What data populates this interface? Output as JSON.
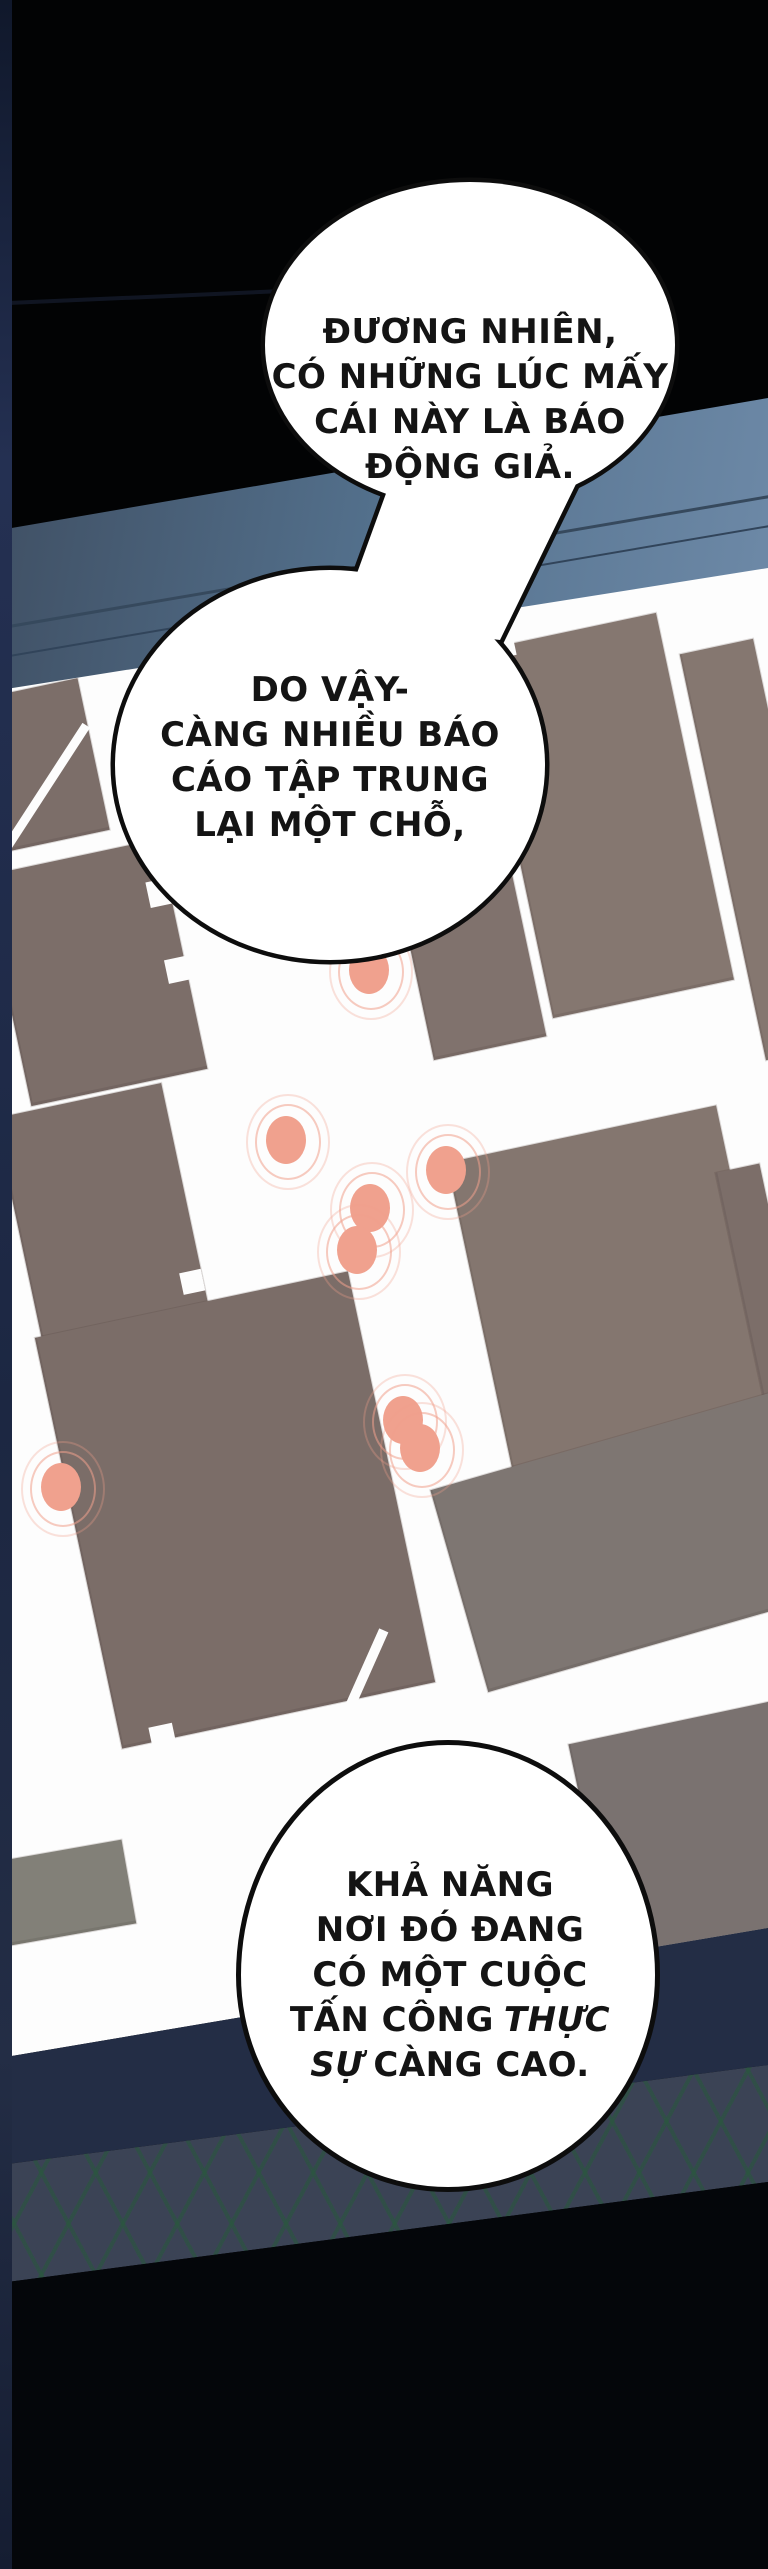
{
  "bubbles": [
    {
      "lines": [
        "ĐƯƠNG NHIÊN,",
        "CÓ NHỮNG LÚC MẤY",
        "CÁI NÀY LÀ BÁO",
        "ĐỘNG GIẢ."
      ]
    },
    {
      "lines": [
        "DO VẬY-",
        "CÀNG NHIỀU BÁO",
        "CÁO TẬP TRUNG",
        "LẠI MỘT CHỖ,"
      ]
    },
    {
      "lines_pre": [
        "KHẢ NĂNG",
        "NƠI ĐÓ ĐANG",
        "CÓ MỘT CUỘC"
      ],
      "line4": {
        "normal": "TẤN CÔNG",
        "italic": "THỰC"
      },
      "line5": {
        "italic": "SỰ",
        "normal": "CÀNG CAO."
      }
    }
  ],
  "map": {
    "alert_color": "#f0a18e",
    "alert_dots": [
      {
        "x": 369,
        "y": 970
      },
      {
        "x": 286,
        "y": 1140
      },
      {
        "x": 446,
        "y": 1170
      },
      {
        "x": 370,
        "y": 1208
      },
      {
        "x": 357,
        "y": 1250
      },
      {
        "x": 403,
        "y": 1420
      },
      {
        "x": 420,
        "y": 1448
      },
      {
        "x": 61,
        "y": 1487
      }
    ],
    "buildings": [
      {
        "x": -35,
        "y": 690,
        "w": 130,
        "h": 155,
        "rot": -12,
        "color": "#7c6e69"
      },
      {
        "x": 5,
        "y": 855,
        "w": 180,
        "h": 235,
        "rot": -12,
        "color": "#7c6e69",
        "notches": [
          {
            "dx": 158,
            "dy": 40,
            "s": 26
          },
          {
            "dx": 160,
            "dy": 120,
            "s": 24
          }
        ]
      },
      {
        "x": 512,
        "y": 628,
        "w": 185,
        "h": 375,
        "rot": -12,
        "color": "#857770",
        "notches": [
          {
            "dx": 20,
            "dy": -8,
            "s": 20
          }
        ]
      },
      {
        "x": 722,
        "y": 642,
        "w": 75,
        "h": 415,
        "rot": -12,
        "color": "#857770"
      },
      {
        "x": 415,
        "y": 880,
        "w": 115,
        "h": 170,
        "rot": -12,
        "color": "#80726d"
      },
      {
        "x": 18,
        "y": 1098,
        "w": 170,
        "h": 240,
        "rot": -12,
        "color": "#7c6e69",
        "notches": [
          {
            "dx": 148,
            "dy": 190,
            "s": 22
          }
        ]
      },
      {
        "x": 482,
        "y": 1130,
        "w": 275,
        "h": 365,
        "rot": -12,
        "color": "#84766f",
        "notches": [
          {
            "dx": 250,
            "dy": 300,
            "s": 24
          },
          {
            "dx": 60,
            "dy": 350,
            "s": 22
          }
        ]
      },
      {
        "x": 745,
        "y": 1165,
        "w": 45,
        "h": 290,
        "rot": -12,
        "color": "#7c6e69"
      },
      {
        "x": 75,
        "y": 1300,
        "w": 320,
        "h": 420,
        "rot": -12,
        "color": "#7b6d68",
        "notches": [
          {
            "dx": 30,
            "dy": 405,
            "s": 24
          }
        ]
      },
      {
        "x": 450,
        "y": 1420,
        "w": 480,
        "h": 210,
        "rot": -16,
        "color": "#7e7672"
      },
      {
        "x": 590,
        "y": 1720,
        "w": 210,
        "h": 230,
        "rot": -12,
        "color": "#7a7270"
      },
      {
        "x": -20,
        "y": 1852,
        "w": 150,
        "h": 85,
        "rot": -10,
        "color": "#828078"
      }
    ]
  },
  "colors": {
    "map_bg": "#fdfdfd",
    "band_blue_left": "#3f4f63",
    "band_blue_right": "#6e8aa8",
    "navy_band": "#232d45",
    "hatch_bg": "#3b4355",
    "hatch_line": "#285838",
    "left_strip": "#1c2742",
    "ink": "#141414",
    "top_black": "#020304"
  }
}
